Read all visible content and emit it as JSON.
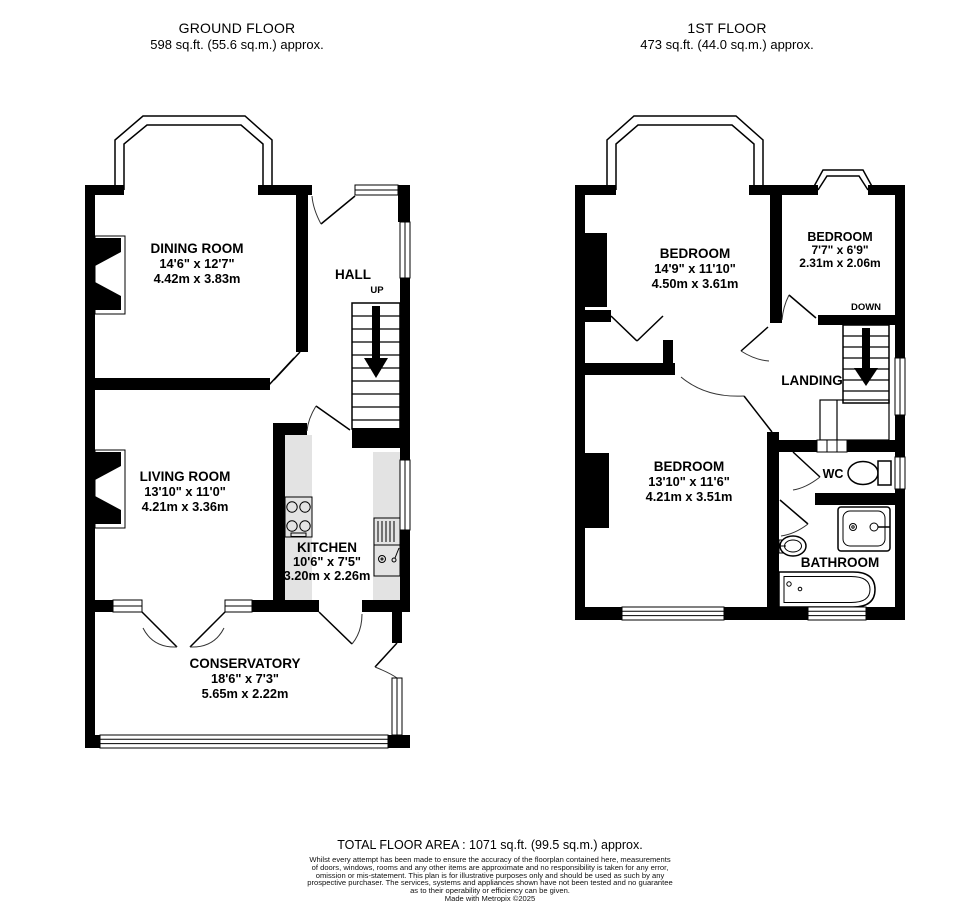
{
  "header": {
    "ground_floor": {
      "title": "GROUND FLOOR",
      "area": "598 sq.ft. (55.6 sq.m.) approx."
    },
    "first_floor": {
      "title": "1ST FLOOR",
      "area": "473 sq.ft. (44.0 sq.m.) approx."
    }
  },
  "ground_floor": {
    "dining_room": {
      "name": "DINING ROOM",
      "imperial": "14'6\" x 12'7\"",
      "metric": "4.42m x 3.83m"
    },
    "hall": {
      "name": "HALL"
    },
    "stairs_label": "UP",
    "living_room": {
      "name": "LIVING ROOM",
      "imperial": "13'10\" x 11'0\"",
      "metric": "4.21m x 3.36m"
    },
    "kitchen": {
      "name": "KITCHEN",
      "imperial": "10'6\" x 7'5\"",
      "metric": "3.20m x 2.26m"
    },
    "conservatory": {
      "name": "CONSERVATORY",
      "imperial": "18'6\" x 7'3\"",
      "metric": "5.65m x 2.22m"
    }
  },
  "first_floor": {
    "bedroom_1": {
      "name": "BEDROOM",
      "imperial": "14'9\" x 11'10\"",
      "metric": "4.50m x 3.61m"
    },
    "bedroom_2": {
      "name": "BEDROOM",
      "imperial": "7'7\" x 6'9\"",
      "metric": "2.31m x 2.06m"
    },
    "stairs_label": "DOWN",
    "landing": {
      "name": "LANDING"
    },
    "bedroom_3": {
      "name": "BEDROOM",
      "imperial": "13'10\" x 11'6\"",
      "metric": "4.21m x 3.51m"
    },
    "wc": {
      "name": "WC"
    },
    "bathroom": {
      "name": "BATHROOM"
    }
  },
  "footer": {
    "total": "TOTAL FLOOR AREA : 1071 sq.ft. (99.5 sq.m.) approx.",
    "disclaimer_lines": [
      "Whilst every attempt has been made to ensure the accuracy of the floorplan contained here, measurements",
      "of doors, windows, rooms and any other items are approximate and no responsibility is taken for any error,",
      "omission or mis-statement. This plan is for illustrative purposes only and should be used as such by any",
      "prospective purchaser. The services, systems and appliances shown have not been tested and no guarantee",
      "as to their operability or efficiency can be given."
    ],
    "credit": "Made with Metropix ©2025"
  },
  "colors": {
    "wall": "#000000",
    "counter": "#e3e3e3",
    "background": "#ffffff"
  }
}
